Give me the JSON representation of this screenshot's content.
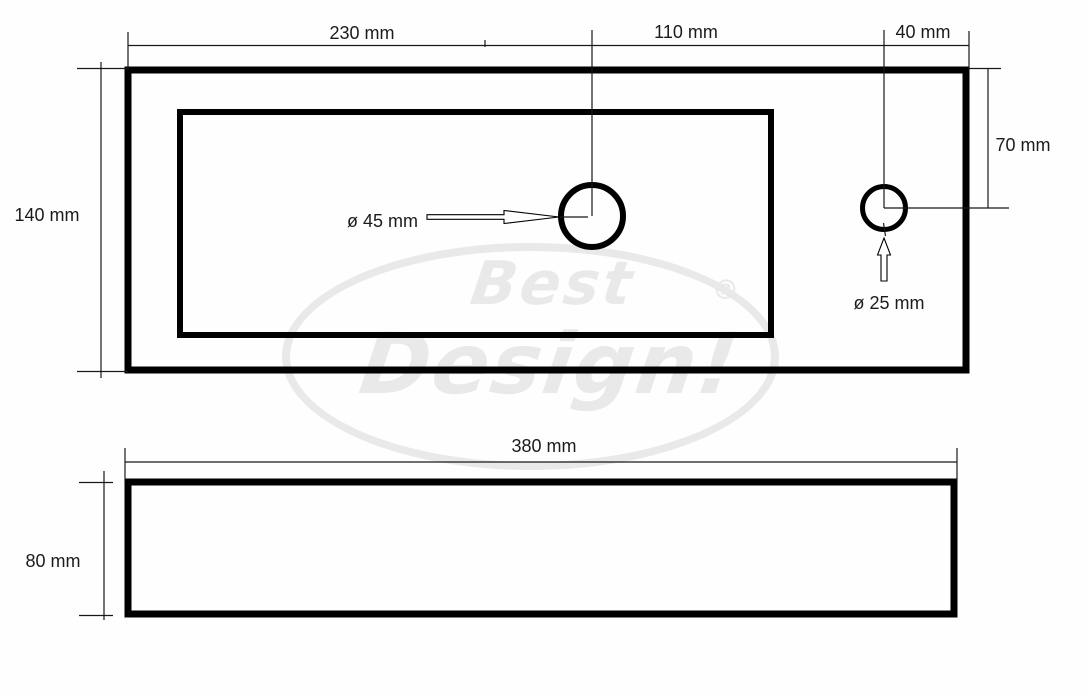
{
  "watermark": {
    "word_top": "Best",
    "word_bottom": "Design!",
    "registered_mark": "®"
  },
  "top_view": {
    "width_left": "230 mm",
    "width_mid": "110 mm",
    "width_right": "40 mm",
    "height_left": "140 mm",
    "hole_offset_right": "70 mm",
    "drain_hole_diameter": "ø 45 mm",
    "tap_hole_diameter": "ø 25 mm"
  },
  "front_view": {
    "width": "380 mm",
    "height": "80 mm"
  },
  "colors": {
    "line": "#000000",
    "label_text": "#1b1b1b",
    "watermark": "#e9e9e9",
    "background": "#fefefe"
  }
}
